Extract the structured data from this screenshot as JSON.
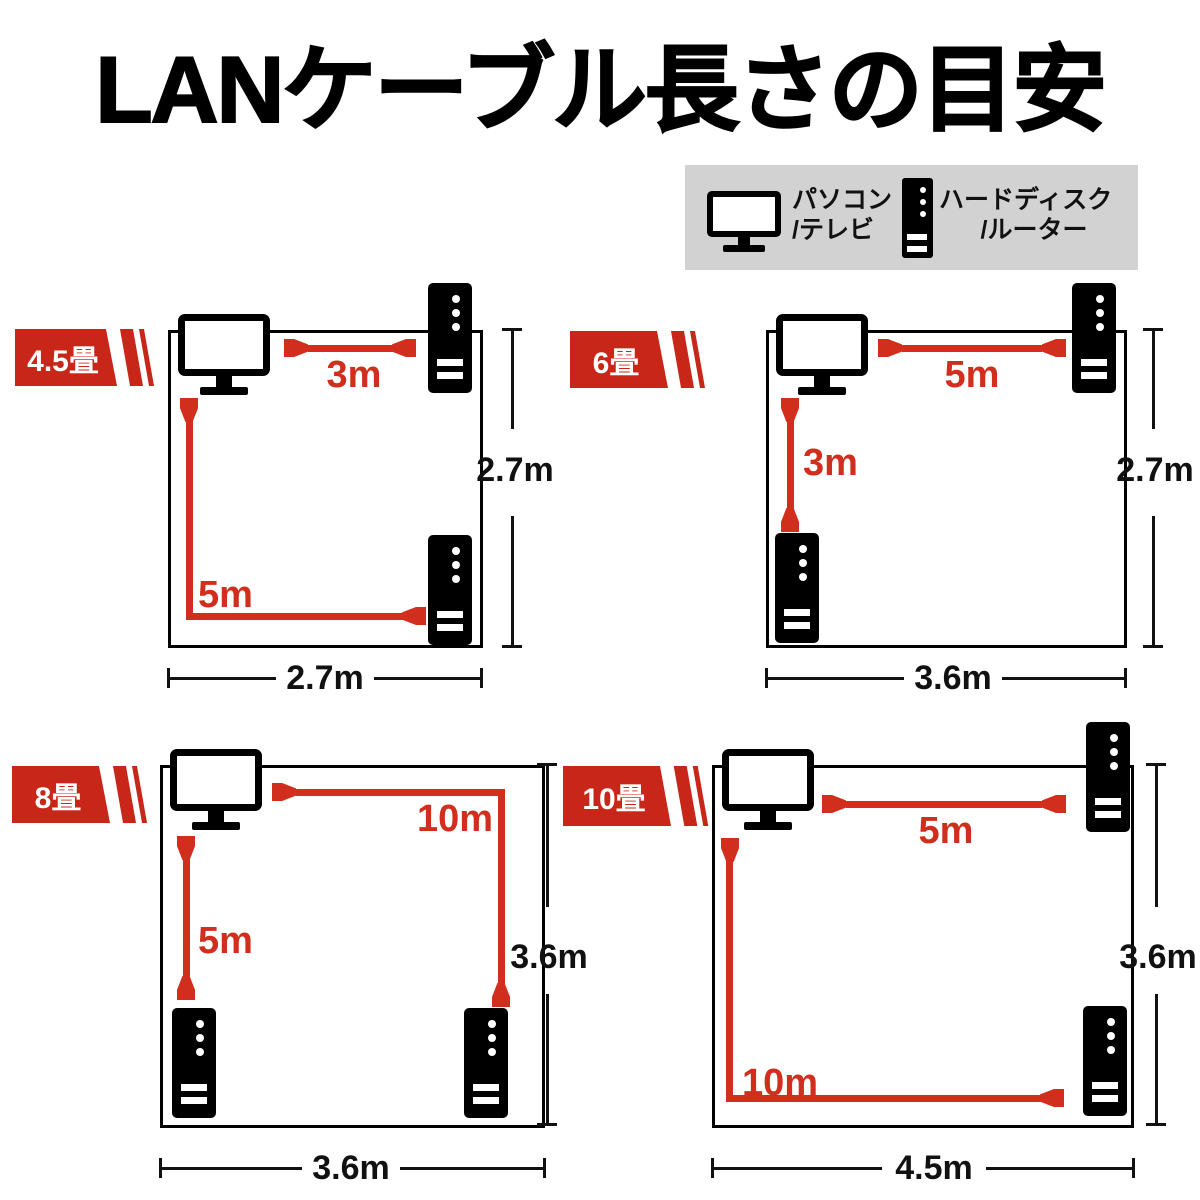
{
  "title": "LANケーブル長さの目安",
  "legend": {
    "pc": {
      "line1": "パソコン",
      "line2": "/テレビ"
    },
    "router": {
      "line1": "ハードディスク",
      "line2": "/ルーター"
    }
  },
  "colors": {
    "badge_red": "#c9261a",
    "cable_red": "#d12e1d",
    "legend_bg": "#d2d2d2",
    "line_black": "#111111"
  },
  "rooms": [
    {
      "badge": "4.5畳",
      "cable1": "3m",
      "cable2": "5m",
      "width": "2.7m",
      "height": "2.7m"
    },
    {
      "badge": "6畳",
      "cable1": "5m",
      "cable2": "3m",
      "width": "3.6m",
      "height": "2.7m"
    },
    {
      "badge": "8畳",
      "cable1": "10m",
      "cable2": "5m",
      "width": "3.6m",
      "height": "3.6m"
    },
    {
      "badge": "10畳",
      "cable1": "5m",
      "cable2": "10m",
      "width": "4.5m",
      "height": "3.6m"
    }
  ]
}
